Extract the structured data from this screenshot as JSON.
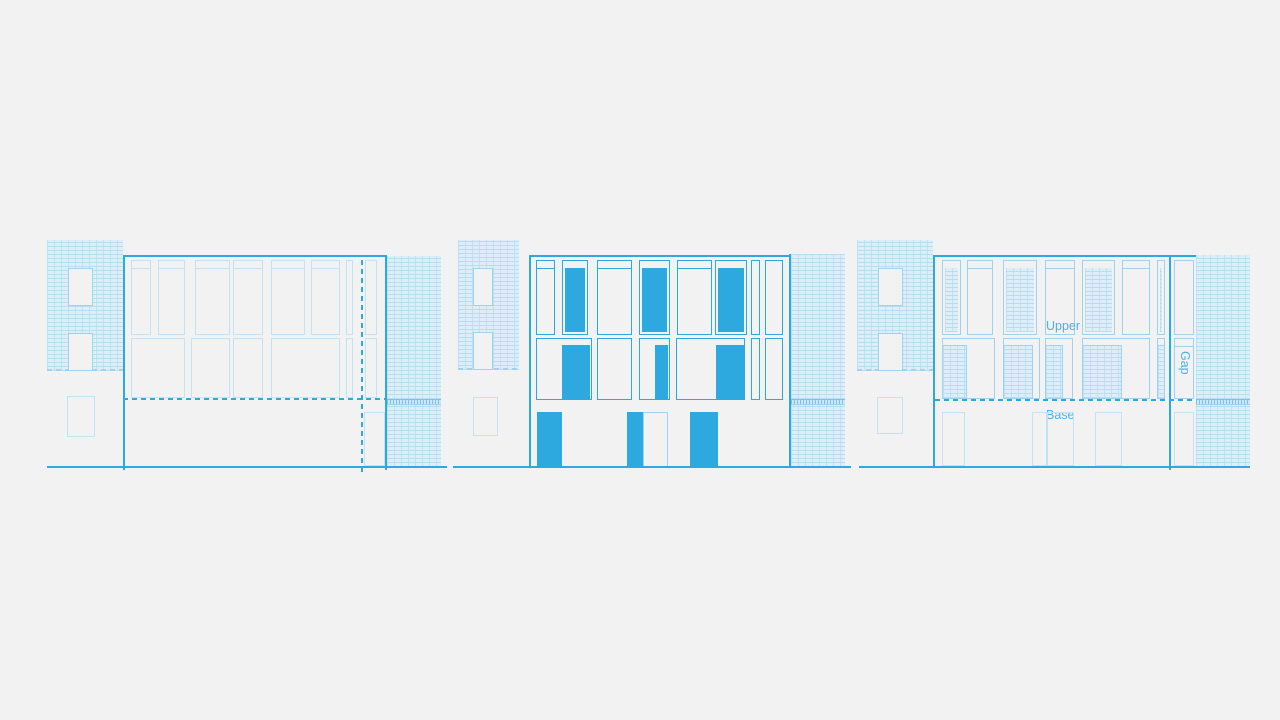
{
  "palette": {
    "background": "#f2f2f2",
    "stroke_blue": "#2ea9e0",
    "light_blue": "#9fd2ee",
    "lighter_blue": "#c3e2f4",
    "label_blue": "#4ab2e6",
    "brick_fill": "#ddeef8",
    "brick_line": "#b7ddf3"
  },
  "labels": {
    "upper": "Upper",
    "gap": "Gap",
    "base": "Base"
  },
  "panels": [
    {
      "name": "elevation-left-outline-study",
      "rects": [
        {
          "n": "neighbor-left-brick-wall",
          "t": "hatch",
          "x": 47,
          "y": 240,
          "w": 76,
          "h": 131
        },
        {
          "n": "neighbor-left-brick-base-dash",
          "t": "dash-h-light",
          "x": 47,
          "y": 369,
          "w": 76,
          "h": 2
        },
        {
          "n": "neighbor-window",
          "t": "outline-light opaque",
          "x": 68,
          "y": 268,
          "w": 25,
          "h": 38
        },
        {
          "n": "neighbor-window",
          "t": "outline-light opaque",
          "x": 68,
          "y": 333,
          "w": 25,
          "h": 38
        },
        {
          "n": "neighbor-lower-window",
          "t": "outline-lighter",
          "x": 67,
          "y": 396,
          "w": 28,
          "h": 41
        },
        {
          "n": "facade-top-line",
          "t": "hline",
          "x": 123,
          "y": 255,
          "w": 264,
          "h": 2
        },
        {
          "n": "facade-left-edge",
          "t": "hline",
          "x": 123,
          "y": 255,
          "w": 2,
          "h": 215
        },
        {
          "n": "facade-right-edge",
          "t": "hline",
          "x": 385,
          "y": 255,
          "w": 2,
          "h": 215
        },
        {
          "n": "upper-window",
          "t": "outline-lighter",
          "x": 131,
          "y": 260,
          "w": 20,
          "h": 75,
          "tr": 1
        },
        {
          "n": "upper-window",
          "t": "outline-lighter",
          "x": 158,
          "y": 260,
          "w": 27,
          "h": 75,
          "tr": 1
        },
        {
          "n": "upper-window",
          "t": "outline-lighter",
          "x": 195,
          "y": 260,
          "w": 35,
          "h": 75,
          "tr": 1
        },
        {
          "n": "upper-window",
          "t": "outline-lighter",
          "x": 233,
          "y": 260,
          "w": 30,
          "h": 75,
          "tr": 1
        },
        {
          "n": "upper-window",
          "t": "outline-lighter",
          "x": 271,
          "y": 260,
          "w": 34,
          "h": 75,
          "tr": 1
        },
        {
          "n": "upper-window",
          "t": "outline-lighter",
          "x": 311,
          "y": 260,
          "w": 29,
          "h": 75,
          "tr": 1
        },
        {
          "n": "upper-window-narrow",
          "t": "outline-lighter",
          "x": 346,
          "y": 260,
          "w": 7,
          "h": 75
        },
        {
          "n": "upper-window",
          "t": "outline-lighter",
          "x": 365,
          "y": 260,
          "w": 12,
          "h": 75
        },
        {
          "n": "mid-window",
          "t": "outline-lighter",
          "x": 131,
          "y": 338,
          "w": 54,
          "h": 60
        },
        {
          "n": "mid-window",
          "t": "outline-lighter",
          "x": 191,
          "y": 338,
          "w": 39,
          "h": 60
        },
        {
          "n": "mid-window",
          "t": "outline-lighter",
          "x": 233,
          "y": 338,
          "w": 30,
          "h": 60
        },
        {
          "n": "mid-window",
          "t": "outline-lighter",
          "x": 271,
          "y": 338,
          "w": 69,
          "h": 60
        },
        {
          "n": "mid-window-narrow",
          "t": "outline-lighter",
          "x": 346,
          "y": 338,
          "w": 7,
          "h": 60
        },
        {
          "n": "mid-window",
          "t": "outline-lighter",
          "x": 365,
          "y": 338,
          "w": 12,
          "h": 60
        },
        {
          "n": "base-level-dashed-line",
          "t": "dash-h",
          "x": 123,
          "y": 398,
          "w": 263,
          "h": 2
        },
        {
          "n": "party-wall-dashed-line",
          "t": "dash-v",
          "x": 361,
          "y": 255,
          "w": 2,
          "h": 217
        },
        {
          "n": "base-door",
          "t": "outline-lighter",
          "x": 364,
          "y": 412,
          "w": 21,
          "h": 54
        },
        {
          "n": "neighbor-right-brick-wall",
          "t": "hatch",
          "x": 387,
          "y": 256,
          "w": 54,
          "h": 211
        },
        {
          "n": "neighbor-right-soldier-band",
          "t": "band",
          "x": 387,
          "y": 399,
          "w": 54,
          "h": 6
        },
        {
          "n": "ground-line",
          "t": "hline",
          "x": 47,
          "y": 466,
          "w": 400,
          "h": 2
        }
      ]
    },
    {
      "name": "elevation-middle-solid-infill",
      "rects": [
        {
          "n": "neighbor-left-brick-wall",
          "t": "hatch",
          "x": 458,
          "y": 240,
          "w": 61,
          "h": 130
        },
        {
          "n": "neighbor-left-brick-base-dash",
          "t": "dash-h-light",
          "x": 458,
          "y": 368,
          "w": 61,
          "h": 2
        },
        {
          "n": "neighbor-window",
          "t": "outline-light opaque",
          "x": 473,
          "y": 268,
          "w": 20,
          "h": 38
        },
        {
          "n": "neighbor-window",
          "t": "outline-light opaque",
          "x": 473,
          "y": 332,
          "w": 20,
          "h": 38
        },
        {
          "n": "neighbor-lower-window",
          "t": "outline-lighter",
          "x": 473,
          "y": 397,
          "w": 25,
          "h": 39
        },
        {
          "n": "facade-top-line",
          "t": "hline",
          "x": 529,
          "y": 255,
          "w": 262,
          "h": 2
        },
        {
          "n": "facade-left-edge",
          "t": "hline",
          "x": 529,
          "y": 255,
          "w": 2,
          "h": 212
        },
        {
          "n": "facade-right-edge",
          "t": "hline",
          "x": 789,
          "y": 254,
          "w": 2,
          "h": 214
        },
        {
          "n": "upper-window",
          "t": "outline",
          "x": 536,
          "y": 260,
          "w": 19,
          "h": 75,
          "tr": 1
        },
        {
          "n": "upper-window-solid",
          "t": "solidwin",
          "x": 562,
          "y": 260,
          "w": 26,
          "h": 75
        },
        {
          "n": "upper-window",
          "t": "outline",
          "x": 597,
          "y": 260,
          "w": 35,
          "h": 75,
          "tr": 1
        },
        {
          "n": "upper-window-solid",
          "t": "solidwin",
          "x": 639,
          "y": 260,
          "w": 31,
          "h": 75
        },
        {
          "n": "upper-window",
          "t": "outline",
          "x": 677,
          "y": 260,
          "w": 35,
          "h": 75,
          "tr": 1
        },
        {
          "n": "upper-window-solid",
          "t": "solidwin",
          "x": 715,
          "y": 260,
          "w": 32,
          "h": 75
        },
        {
          "n": "upper-window-narrow",
          "t": "outline",
          "x": 751,
          "y": 260,
          "w": 9,
          "h": 75
        },
        {
          "n": "upper-window",
          "t": "outline",
          "x": 765,
          "y": 260,
          "w": 18,
          "h": 75
        },
        {
          "n": "mid-window-frame",
          "t": "outline",
          "x": 536,
          "y": 338,
          "w": 56,
          "h": 62
        },
        {
          "n": "mid-window-solid-infill",
          "t": "solid",
          "x": 562,
          "y": 345,
          "w": 28,
          "h": 54
        },
        {
          "n": "mid-window-frame",
          "t": "outline",
          "x": 597,
          "y": 338,
          "w": 35,
          "h": 62
        },
        {
          "n": "mid-window-frame",
          "t": "outline",
          "x": 639,
          "y": 338,
          "w": 31,
          "h": 62
        },
        {
          "n": "mid-window-solid-infill",
          "t": "solid",
          "x": 655,
          "y": 345,
          "w": 13,
          "h": 54
        },
        {
          "n": "mid-window-frame",
          "t": "outline",
          "x": 676,
          "y": 338,
          "w": 69,
          "h": 62
        },
        {
          "n": "mid-window-solid-infill",
          "t": "solid",
          "x": 716,
          "y": 345,
          "w": 28,
          "h": 54
        },
        {
          "n": "mid-window-narrow",
          "t": "outline",
          "x": 751,
          "y": 338,
          "w": 9,
          "h": 62
        },
        {
          "n": "mid-window-frame",
          "t": "outline",
          "x": 765,
          "y": 338,
          "w": 18,
          "h": 62
        },
        {
          "n": "base-door-solid",
          "t": "solid",
          "x": 537,
          "y": 412,
          "w": 25,
          "h": 55
        },
        {
          "n": "base-door-solid",
          "t": "solid",
          "x": 627,
          "y": 412,
          "w": 16,
          "h": 55
        },
        {
          "n": "base-door",
          "t": "outline-light",
          "x": 643,
          "y": 412,
          "w": 25,
          "h": 55
        },
        {
          "n": "base-door-solid",
          "t": "solid",
          "x": 690,
          "y": 412,
          "w": 28,
          "h": 55
        },
        {
          "n": "neighbor-right-brick-wall",
          "t": "hatch",
          "x": 791,
          "y": 254,
          "w": 54,
          "h": 213
        },
        {
          "n": "neighbor-right-soldier-band",
          "t": "band",
          "x": 791,
          "y": 399,
          "w": 54,
          "h": 6
        },
        {
          "n": "ground-line",
          "t": "hline",
          "x": 453,
          "y": 466,
          "w": 398,
          "h": 2
        }
      ]
    },
    {
      "name": "elevation-right-hatch-annotated",
      "rects": [
        {
          "n": "neighbor-left-brick-wall",
          "t": "hatch",
          "x": 857,
          "y": 240,
          "w": 76,
          "h": 131
        },
        {
          "n": "neighbor-left-brick-base-dash",
          "t": "dash-h-light",
          "x": 857,
          "y": 369,
          "w": 76,
          "h": 2
        },
        {
          "n": "neighbor-window",
          "t": "outline-light opaque",
          "x": 878,
          "y": 268,
          "w": 25,
          "h": 38
        },
        {
          "n": "neighbor-window",
          "t": "outline-light opaque",
          "x": 878,
          "y": 333,
          "w": 25,
          "h": 38
        },
        {
          "n": "neighbor-lower-window",
          "t": "outline-lighter",
          "x": 877,
          "y": 397,
          "w": 26,
          "h": 37
        },
        {
          "n": "facade-top-line",
          "t": "hline",
          "x": 935,
          "y": 255,
          "w": 261,
          "h": 2
        },
        {
          "n": "facade-left-edge",
          "t": "hline",
          "x": 933,
          "y": 255,
          "w": 2,
          "h": 212
        },
        {
          "n": "facade-right-edge",
          "t": "hline",
          "x": 1169,
          "y": 255,
          "w": 2,
          "h": 215
        },
        {
          "n": "upper-window-hatched",
          "t": "hatchwin",
          "x": 942,
          "y": 260,
          "w": 19,
          "h": 75
        },
        {
          "n": "upper-window",
          "t": "outline-light",
          "x": 967,
          "y": 260,
          "w": 26,
          "h": 75,
          "tr": 1
        },
        {
          "n": "upper-window-hatched",
          "t": "hatchwin",
          "x": 1003,
          "y": 260,
          "w": 34,
          "h": 75
        },
        {
          "n": "upper-window",
          "t": "outline-light",
          "x": 1045,
          "y": 260,
          "w": 30,
          "h": 75,
          "tr": 1
        },
        {
          "n": "upper-window-hatched",
          "t": "hatchwin",
          "x": 1082,
          "y": 260,
          "w": 33,
          "h": 75
        },
        {
          "n": "upper-window",
          "t": "outline-light",
          "x": 1122,
          "y": 260,
          "w": 28,
          "h": 75,
          "tr": 1
        },
        {
          "n": "upper-window-hatched-narrow",
          "t": "hatchwin",
          "x": 1157,
          "y": 260,
          "w": 8,
          "h": 75
        },
        {
          "n": "mid-window-frame",
          "t": "outline-light",
          "x": 942,
          "y": 338,
          "w": 53,
          "h": 61
        },
        {
          "n": "mid-window-hatch-infill",
          "t": "hatch-b",
          "x": 942,
          "y": 345,
          "w": 25,
          "h": 54
        },
        {
          "n": "mid-window-frame",
          "t": "outline-light",
          "x": 1003,
          "y": 338,
          "w": 37,
          "h": 61
        },
        {
          "n": "mid-window-hatch-infill",
          "t": "hatch-b",
          "x": 1003,
          "y": 345,
          "w": 30,
          "h": 54
        },
        {
          "n": "mid-window-frame",
          "t": "outline-light",
          "x": 1045,
          "y": 338,
          "w": 28,
          "h": 61
        },
        {
          "n": "mid-window-hatch-infill",
          "t": "hatch-b",
          "x": 1045,
          "y": 345,
          "w": 18,
          "h": 54
        },
        {
          "n": "mid-window-frame",
          "t": "outline-light",
          "x": 1082,
          "y": 338,
          "w": 68,
          "h": 61
        },
        {
          "n": "mid-window-hatch-infill",
          "t": "hatch-b",
          "x": 1082,
          "y": 345,
          "w": 40,
          "h": 54
        },
        {
          "n": "mid-window-frame-narrow",
          "t": "outline-light",
          "x": 1157,
          "y": 338,
          "w": 8,
          "h": 61
        },
        {
          "n": "mid-window-hatch-infill",
          "t": "hatch-b",
          "x": 1157,
          "y": 345,
          "w": 8,
          "h": 54
        },
        {
          "n": "base-level-dashed-line",
          "t": "dash-h",
          "x": 935,
          "y": 399,
          "w": 261,
          "h": 2
        },
        {
          "n": "upper-zone-label",
          "t": "label",
          "x": 1046,
          "y": 320,
          "w": 40,
          "h": 14,
          "bind": "labels.upper"
        },
        {
          "n": "base-zone-label",
          "t": "label",
          "x": 1046,
          "y": 409,
          "w": 36,
          "h": 14,
          "bind": "labels.base"
        },
        {
          "n": "gap-zone-label",
          "t": "vlabel",
          "x": 1177,
          "y": 351,
          "w": 14,
          "h": 32,
          "bind": "labels.gap"
        },
        {
          "n": "base-door",
          "t": "outline-lighter",
          "x": 942,
          "y": 412,
          "w": 23,
          "h": 54
        },
        {
          "n": "base-door",
          "t": "outline-lighter",
          "x": 1032,
          "y": 412,
          "w": 15,
          "h": 54
        },
        {
          "n": "base-door",
          "t": "outline-lighter",
          "x": 1047,
          "y": 412,
          "w": 27,
          "h": 54
        },
        {
          "n": "base-door",
          "t": "outline-lighter",
          "x": 1095,
          "y": 412,
          "w": 27,
          "h": 54
        },
        {
          "n": "gap-band-upper-window",
          "t": "outline-light",
          "x": 1174,
          "y": 260,
          "w": 20,
          "h": 75
        },
        {
          "n": "gap-band-mid-window",
          "t": "outline-light",
          "x": 1174,
          "y": 338,
          "w": 20,
          "h": 61,
          "tr": 1
        },
        {
          "n": "gap-band-door",
          "t": "outline-lighter",
          "x": 1174,
          "y": 412,
          "w": 20,
          "h": 54
        },
        {
          "n": "neighbor-right-brick-wall",
          "t": "hatch",
          "x": 1196,
          "y": 255,
          "w": 54,
          "h": 212
        },
        {
          "n": "neighbor-right-soldier-band",
          "t": "band",
          "x": 1196,
          "y": 399,
          "w": 54,
          "h": 6
        },
        {
          "n": "ground-line",
          "t": "hline",
          "x": 859,
          "y": 466,
          "w": 391,
          "h": 2
        }
      ]
    }
  ]
}
